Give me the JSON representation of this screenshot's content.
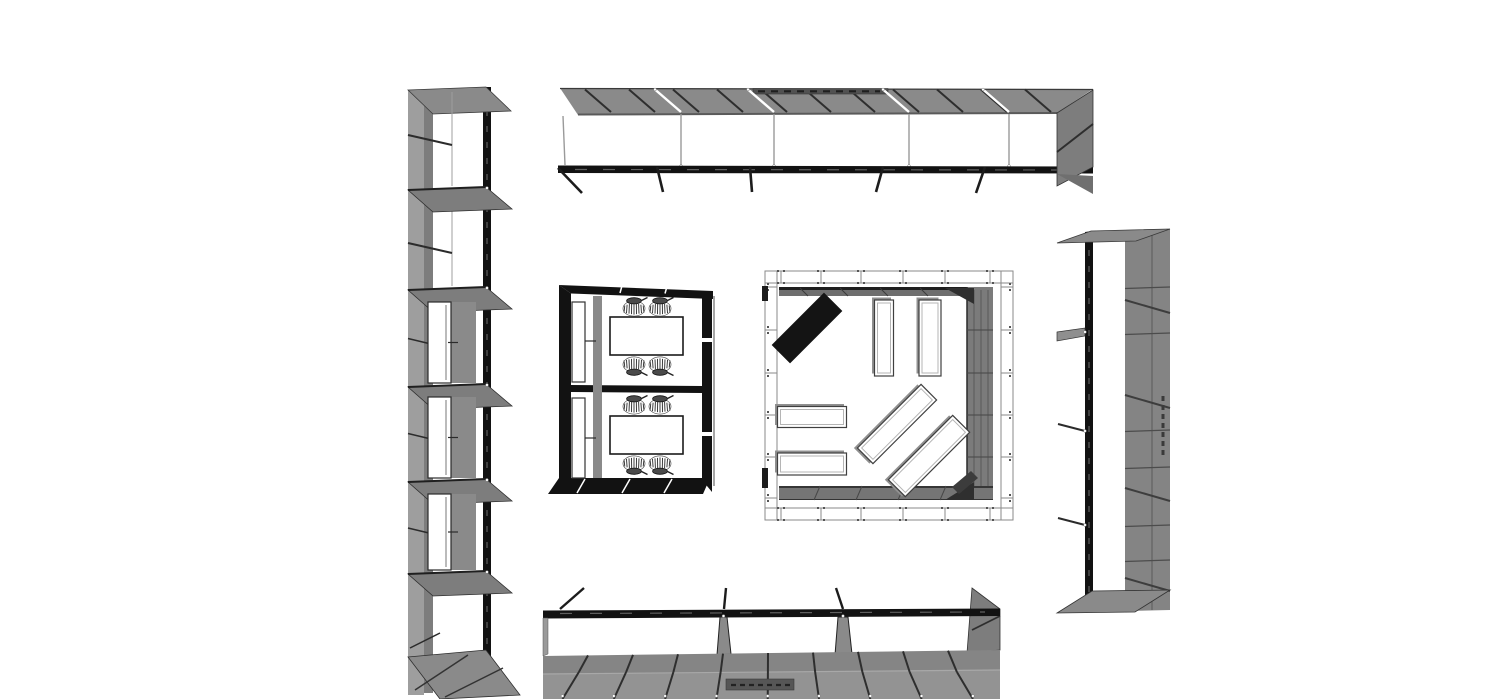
{
  "meta": {
    "view": "3d-furniture-plan-top-view",
    "visible_text": [],
    "background": "#ffffff",
    "width": 1500,
    "height": 699
  },
  "palette": {
    "panel": "#8a8a8a",
    "panel_light": "#9e9e9e",
    "panel_mid": "#7d7d7d",
    "panel_dark": "#6f6f6f",
    "edge": "#2d2d2d",
    "black": "#121212",
    "line_dark": "#333333",
    "dash": "#5f5f5f",
    "white": "#ffffff",
    "frame": "#8a8a8a",
    "floor_hi": "#858585",
    "floor_lo": "#939393",
    "recess": "#515151"
  },
  "objects": [
    {
      "name": "shelf-column-left",
      "type": "tall shelving unit",
      "door_count": 3
    },
    {
      "name": "shelf-row-top",
      "type": "long wall shelving",
      "bays": 5
    },
    {
      "name": "shelf-column-right",
      "type": "tall shelving unit"
    },
    {
      "name": "shelf-row-bottom",
      "type": "long low shelving",
      "bays": 4
    },
    {
      "name": "meeting-booths",
      "type": "two enclosed booths",
      "tables": 2,
      "chairs": 8
    },
    {
      "name": "display-room",
      "type": "framed room",
      "benches": 6,
      "black_panels": 1
    }
  ],
  "left_shelf": {
    "x": {
      "left": 408,
      "panel_mid": 424,
      "panel_r": 433,
      "black_l": 483,
      "black_r": 491,
      "flare": 512
    },
    "top": 88,
    "bottom": 695,
    "top_face": [
      [
        408,
        90
      ],
      [
        486,
        87
      ],
      [
        511,
        111
      ],
      [
        433,
        114
      ]
    ],
    "shelves": [
      188,
      288,
      385,
      480,
      572
    ],
    "floor": [
      [
        408,
        657
      ],
      [
        486,
        650
      ],
      [
        520,
        695
      ],
      [
        440,
        699
      ]
    ],
    "struts": [
      135,
      243
    ],
    "inner_lines": [
      [
        92,
        186
      ],
      [
        210,
        286
      ]
    ],
    "door_cells": [
      [
        302,
        383
      ],
      [
        397,
        478
      ],
      [
        494,
        570
      ]
    ],
    "bottom_diag": [
      410,
      648,
      440,
      633
    ]
  },
  "top_shelf": {
    "band": [
      [
        560,
        88
      ],
      [
        1093,
        89
      ],
      [
        1057,
        113
      ],
      [
        578,
        115
      ]
    ],
    "front_left": [
      563,
      116,
      565,
      165
    ],
    "black_band": [
      [
        558,
        165.5
      ],
      [
        1093,
        166.5
      ],
      [
        1093,
        173.5
      ],
      [
        558,
        173
      ]
    ],
    "diag_start": 585,
    "diag_step": 44,
    "diag_count": 11,
    "boundaries": [
      655,
      748,
      883,
      983
    ],
    "legs": [
      [
        558,
        168,
        582,
        193
      ],
      [
        657,
        167,
        663,
        192
      ],
      [
        750,
        167,
        752,
        192
      ],
      [
        883,
        167,
        876,
        192
      ],
      [
        985,
        167,
        976,
        193
      ]
    ],
    "recess": [
      753,
      88.5,
      135,
      5.5
    ],
    "end_panel": [
      [
        1057,
        113
      ],
      [
        1093,
        90
      ],
      [
        1093,
        167
      ],
      [
        1057,
        186
      ]
    ],
    "end_diag": [
      1057,
      152,
      1093,
      124
    ],
    "end_foot": [
      [
        1057,
        174
      ],
      [
        1093,
        176
      ],
      [
        1093,
        194
      ]
    ]
  },
  "right_shelf": {
    "top_face": [
      [
        1057,
        243
      ],
      [
        1091,
        231
      ],
      [
        1170,
        229
      ],
      [
        1136,
        241
      ]
    ],
    "black": [
      [
        1085,
        232
      ],
      [
        1093,
        231
      ],
      [
        1093,
        612
      ],
      [
        1085,
        613
      ]
    ],
    "panel": [
      [
        1125,
        230
      ],
      [
        1170,
        229
      ],
      [
        1170,
        610
      ],
      [
        1125,
        611
      ]
    ],
    "panel_seam_x": 1152,
    "panel_seams": [
      287,
      333,
      430,
      467,
      525,
      560
    ],
    "panel_diags": [
      300,
      395,
      488,
      578
    ],
    "shelf_flares": [
      330
    ],
    "struts": [
      424,
      518
    ],
    "bottom_face": [
      [
        1057,
        613
      ],
      [
        1092,
        591
      ],
      [
        1170,
        590
      ],
      [
        1135,
        612
      ]
    ],
    "dash_marks": [
      1163,
      396,
      1163,
      458
    ]
  },
  "bottom_shelf": {
    "black_band": [
      [
        543,
        610.5
      ],
      [
        1000,
        608.5
      ],
      [
        1000,
        616
      ],
      [
        543,
        618.5
      ]
    ],
    "floor_upper": [
      [
        543,
        656
      ],
      [
        1000,
        650
      ],
      [
        1000,
        670
      ],
      [
        543,
        674
      ]
    ],
    "floor_lower": [
      [
        543,
        674
      ],
      [
        1000,
        670
      ],
      [
        1000,
        699
      ],
      [
        543,
        699
      ]
    ],
    "grid_xs": [
      588,
      633,
      678,
      723,
      768,
      813,
      858,
      903,
      948
    ],
    "grid_cx": 770,
    "grid_f1": 0.05,
    "grid_f2": 0.14,
    "legs": [
      [
        560,
        609,
        584,
        588
      ],
      [
        724,
        609,
        726,
        588
      ],
      [
        843,
        609,
        836,
        588
      ]
    ],
    "dividers": [
      [
        720,
        727
      ],
      [
        838,
        848
      ]
    ],
    "left_cap": [
      [
        543,
        618
      ],
      [
        548,
        618
      ],
      [
        548,
        654
      ],
      [
        543,
        656
      ]
    ],
    "end_panel": [
      [
        972,
        588
      ],
      [
        1000,
        609
      ],
      [
        1000,
        650
      ],
      [
        967,
        653
      ]
    ],
    "end_diag": [
      972,
      630,
      1000,
      616
    ],
    "recess": [
      726,
      679,
      68,
      11
    ]
  },
  "booths": {
    "top_band": [
      [
        559,
        285
      ],
      [
        713,
        291
      ],
      [
        713,
        299
      ],
      [
        571,
        293.5
      ]
    ],
    "left_band": [
      [
        559,
        285
      ],
      [
        571,
        293.5
      ],
      [
        571,
        480
      ],
      [
        559,
        478
      ]
    ],
    "right_band": [
      [
        702,
        296
      ],
      [
        712,
        291
      ],
      [
        712,
        492
      ],
      [
        702,
        480
      ]
    ],
    "right_outer_line": [
      714,
      296,
      714,
      486
    ],
    "bottom_band": [
      [
        559,
        478
      ],
      [
        710,
        478
      ],
      [
        703,
        494
      ],
      [
        548,
        494
      ]
    ],
    "bottom_seams": [
      [
        585,
        479,
        577,
        493
      ],
      [
        630,
        479,
        622,
        493
      ],
      [
        672,
        479,
        664,
        493
      ]
    ],
    "top_seams": [
      [
        622,
        285.8,
        620,
        293
      ],
      [
        667,
        286.5,
        665,
        293.5
      ]
    ],
    "divider": [
      [
        571,
        385
      ],
      [
        702,
        386
      ],
      [
        702,
        393
      ],
      [
        571,
        392
      ]
    ],
    "gray_strip": [
      593,
      296,
      9,
      182
    ],
    "right_notches": [
      338,
      432
    ],
    "doors": [
      [
        572,
        302,
        13,
        80
      ],
      [
        572,
        398,
        13,
        80
      ]
    ],
    "handles": [
      [
        585,
        341,
        596,
        341
      ],
      [
        585,
        438,
        596,
        438
      ]
    ],
    "tables": [
      [
        610,
        317,
        73,
        38
      ],
      [
        610,
        416,
        73,
        38
      ]
    ],
    "chairs": [
      {
        "x": 634,
        "y": 308,
        "flip": false
      },
      {
        "x": 660,
        "y": 308,
        "flip": false
      },
      {
        "x": 634,
        "y": 365,
        "flip": true
      },
      {
        "x": 660,
        "y": 365,
        "flip": true
      },
      {
        "x": 634,
        "y": 406,
        "flip": false
      },
      {
        "x": 660,
        "y": 406,
        "flip": false
      },
      {
        "x": 634,
        "y": 464,
        "flip": true
      },
      {
        "x": 660,
        "y": 464,
        "flip": true
      }
    ]
  },
  "room": {
    "frame": {
      "x1": 765,
      "y1": 271,
      "x2": 1013,
      "y2": 520,
      "inset": 12,
      "ticks_x": [
        781,
        821,
        861,
        903,
        945,
        990
      ],
      "ticks_y": [
        287,
        330,
        373,
        415,
        457,
        498
      ]
    },
    "walls": {
      "top": [
        779,
        287,
        196,
        9
      ],
      "top_edge": [
        779,
        287,
        196,
        3
      ],
      "top_seams": [
        800,
        840,
        880,
        920
      ],
      "right": [
        967,
        287,
        26,
        213
      ],
      "right_seams": [
        974,
        981,
        988
      ],
      "right_ticks": [
        330,
        373,
        415,
        457
      ],
      "bottom": [
        779,
        486,
        214,
        14
      ],
      "bottom_seams": [
        820,
        862,
        904,
        946
      ],
      "brace_tr": [
        [
          945,
          288
        ],
        [
          974,
          288
        ],
        [
          974,
          304
        ]
      ],
      "brace_br": [
        [
          945,
          500
        ],
        [
          974,
          482
        ],
        [
          974,
          500
        ]
      ],
      "corner_block": [
        [
          952,
          487
        ],
        [
          971,
          471
        ],
        [
          978,
          478
        ],
        [
          959,
          494
        ]
      ],
      "left_marks": [
        [
          762,
          286,
          6,
          15
        ],
        [
          762,
          468,
          6,
          20
        ]
      ]
    },
    "benches": [
      {
        "cx": 807,
        "cy": 328,
        "w": 74,
        "h": 26,
        "rot": -45,
        "style": "black"
      },
      {
        "cx": 884,
        "cy": 338,
        "w": 19,
        "h": 76,
        "rot": 0,
        "style": "white"
      },
      {
        "cx": 930,
        "cy": 338,
        "w": 22,
        "h": 76,
        "rot": 0,
        "style": "white"
      },
      {
        "cx": 812,
        "cy": 417,
        "w": 69,
        "h": 21,
        "rot": 0,
        "style": "white"
      },
      {
        "cx": 812,
        "cy": 464,
        "w": 69,
        "h": 22,
        "rot": 0,
        "style": "white"
      },
      {
        "cx": 897,
        "cy": 424,
        "w": 90,
        "h": 22,
        "rot": -45,
        "style": "white"
      },
      {
        "cx": 929,
        "cy": 456,
        "w": 91,
        "h": 24,
        "rot": -45,
        "style": "white"
      }
    ]
  }
}
